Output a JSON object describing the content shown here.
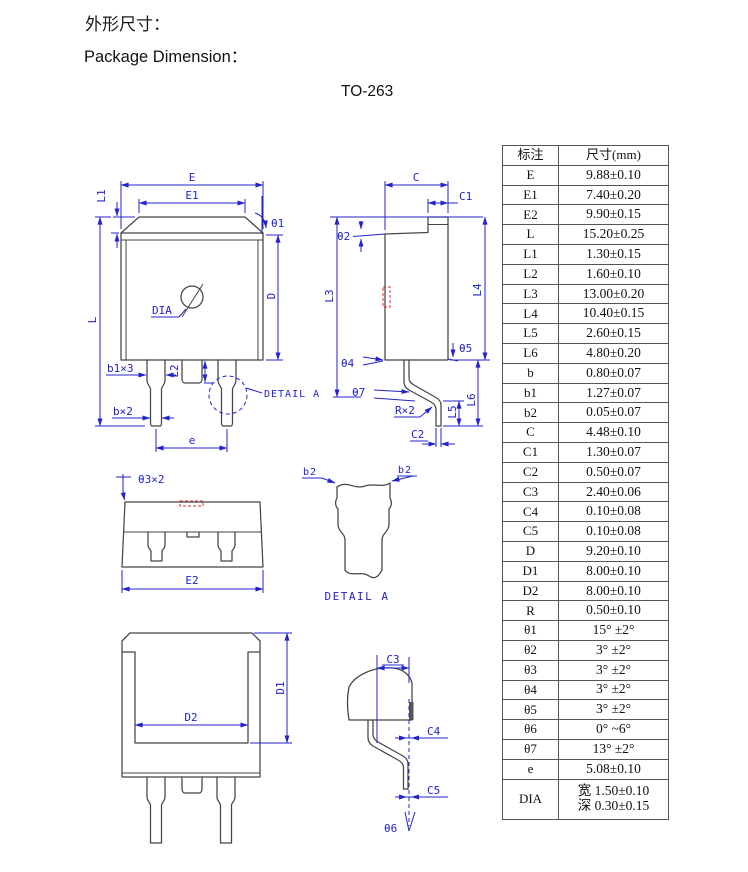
{
  "header": {
    "title_zh": "外形尺寸：",
    "title_en": "Package Dimension：",
    "package": "TO-263"
  },
  "table": {
    "col_headers": [
      "标注",
      "尺寸(mm)"
    ],
    "rows": [
      {
        "label": "E",
        "value": "9.88±0.10"
      },
      {
        "label": "E1",
        "value": "7.40±0.20"
      },
      {
        "label": "E2",
        "value": "9.90±0.15"
      },
      {
        "label": "L",
        "value": "15.20±0.25"
      },
      {
        "label": "L1",
        "value": "1.30±0.15"
      },
      {
        "label": "L2",
        "value": "1.60±0.10"
      },
      {
        "label": "L3",
        "value": "13.00±0.20"
      },
      {
        "label": "L4",
        "value": "10.40±0.15"
      },
      {
        "label": "L5",
        "value": "2.60±0.15"
      },
      {
        "label": "L6",
        "value": "4.80±0.20"
      },
      {
        "label": "b",
        "value": "0.80±0.07"
      },
      {
        "label": "b1",
        "value": "1.27±0.07"
      },
      {
        "label": "b2",
        "value": "0.05±0.07"
      },
      {
        "label": "C",
        "value": "4.48±0.10"
      },
      {
        "label": "C1",
        "value": "1.30±0.07"
      },
      {
        "label": "C2",
        "value": "0.50±0.07"
      },
      {
        "label": "C3",
        "value": "2.40±0.06"
      },
      {
        "label": "C4",
        "value": "0.10±0.08"
      },
      {
        "label": "C5",
        "value": "0.10±0.08"
      },
      {
        "label": "D",
        "value": "9.20±0.10"
      },
      {
        "label": "D1",
        "value": "8.00±0.10"
      },
      {
        "label": "D2",
        "value": "8.00±0.10"
      },
      {
        "label": "R",
        "value": "0.50±0.10"
      },
      {
        "label": "θ1",
        "value": "15° ±2°"
      },
      {
        "label": "θ2",
        "value": "3° ±2°"
      },
      {
        "label": "θ3",
        "value": "3° ±2°"
      },
      {
        "label": "θ4",
        "value": "3° ±2°"
      },
      {
        "label": "θ5",
        "value": "3° ±2°"
      },
      {
        "label": "θ6",
        "value": "0° ~6°"
      },
      {
        "label": "θ7",
        "value": "13° ±2°"
      },
      {
        "label": "e",
        "value": "5.08±0.10"
      },
      {
        "label": "DIA",
        "value": "宽 1.50±0.10\n深 0.30±0.15"
      }
    ]
  },
  "drawings": {
    "front": {
      "E": "E",
      "E1": "E1",
      "L1": "L1",
      "theta1": "θ1",
      "L": "L",
      "D": "D",
      "dia": "DIA",
      "L2": "L2",
      "b1": "b1×3",
      "b": "b×2",
      "e": "e",
      "detail": "DETAIL A"
    },
    "side": {
      "C": "C",
      "C1": "C1",
      "theta2": "θ2",
      "L3": "L3",
      "L4": "L4",
      "theta4": "θ4",
      "theta5": "θ5",
      "theta7": "θ7",
      "r": "R×2",
      "L5": "L5",
      "L6": "L6",
      "C2": "C2"
    },
    "top": {
      "theta3": "θ3×2",
      "E2": "E2"
    },
    "detail_a": {
      "b2l": "b2",
      "b2r": "b2",
      "caption": "DETAIL A"
    },
    "back": {
      "D1": "D1",
      "D2": "D2"
    },
    "lead": {
      "C3": "C3",
      "C4": "C4",
      "C5": "C5",
      "theta6": "θ6"
    }
  },
  "colors": {
    "dimension_blue": "#2323cc",
    "outline_gray": "#454545",
    "highlight_red": "#e03030"
  }
}
